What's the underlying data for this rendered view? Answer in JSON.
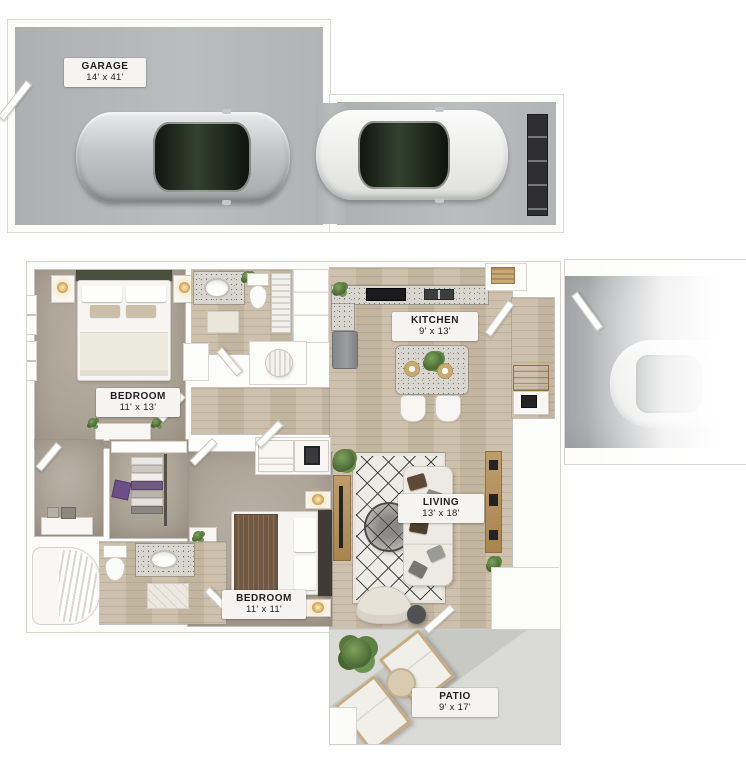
{
  "rooms": {
    "garage": {
      "name": "GARAGE",
      "dims": "14' x 41'"
    },
    "bedroom1": {
      "name": "BEDROOM",
      "dims": "11' x 13'"
    },
    "kitchen": {
      "name": "KITCHEN",
      "dims": "9' x 13'"
    },
    "living": {
      "name": "LIVING",
      "dims": "13' x 18'"
    },
    "bedroom2": {
      "name": "BEDROOM",
      "dims": "11' x 11'"
    },
    "patio": {
      "name": "PATIO",
      "dims": "9' x 17'"
    }
  },
  "colors": {
    "wall": "#fcfcfb",
    "wall_line": "#d9d6d1",
    "garage_floor": "#b5b6b8",
    "carpet": "#aea596",
    "wood": "#c9bca6",
    "patio_floor": "#dadad6",
    "granite": "#d8d6ce",
    "label_bg": "#f5f4f1",
    "label_text": "#1f1f1f",
    "plant_green": "#55703f",
    "garage_door": "#2f2f31",
    "headboard_olive": "#4a4f3d",
    "headboard_brown": "#3f3a33",
    "blanket_brown": "#74593f",
    "furniture_wood": "#b2905f"
  }
}
